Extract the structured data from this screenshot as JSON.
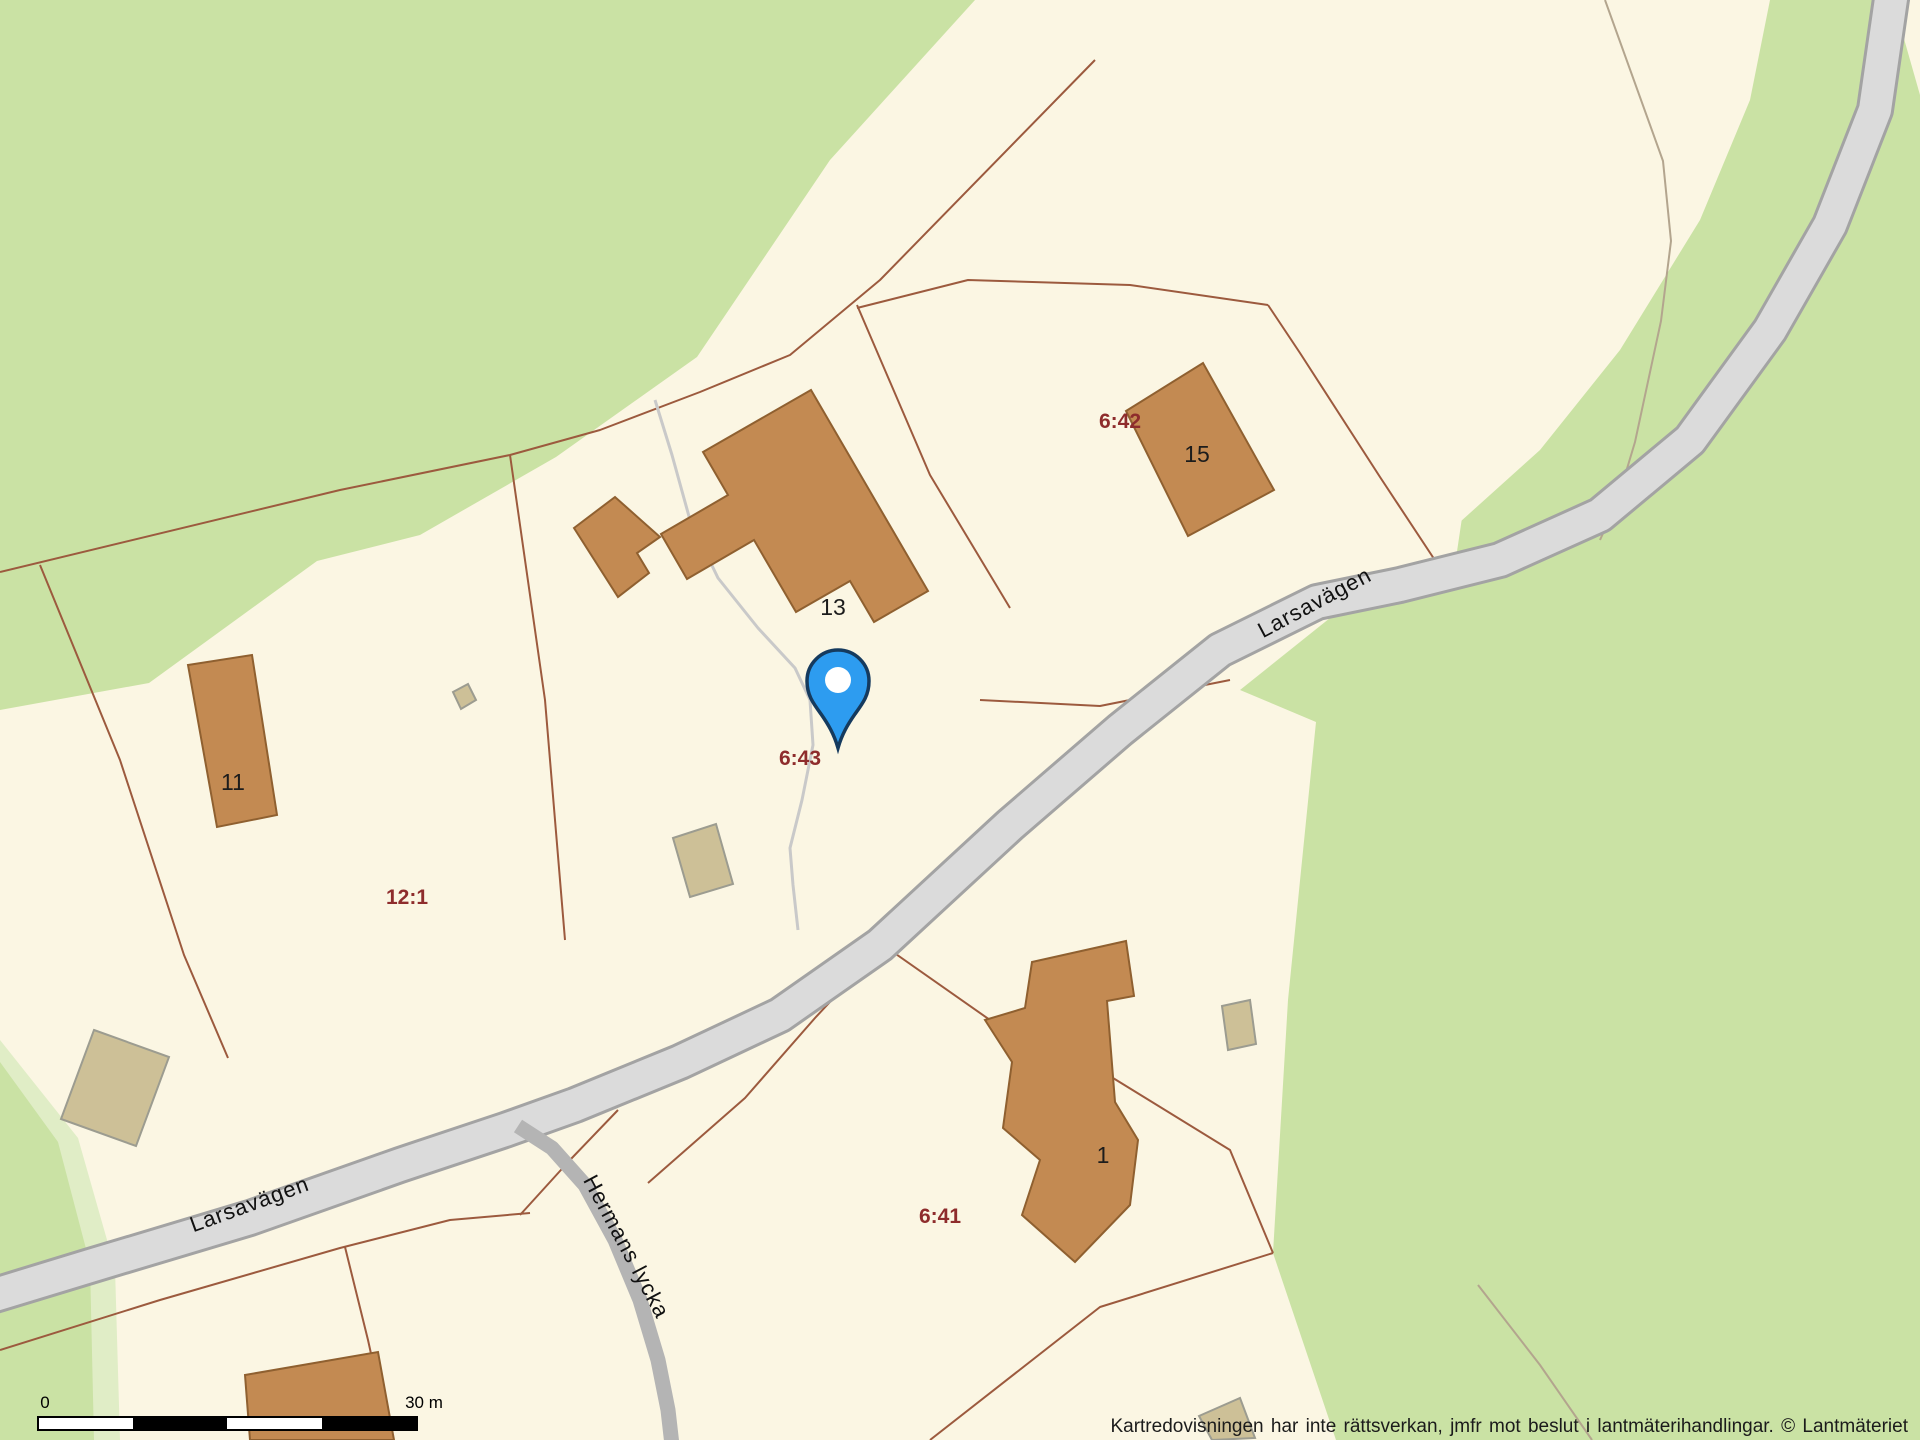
{
  "map": {
    "type": "cadastral-property-map",
    "parcel_labels": [
      {
        "text": "6:42",
        "x": 1120,
        "y": 418
      },
      {
        "text": "6:43",
        "x": 800,
        "y": 756
      },
      {
        "text": "12:1",
        "x": 407,
        "y": 895
      },
      {
        "text": "6:41",
        "x": 940,
        "y": 1214
      }
    ],
    "building_labels": [
      {
        "text": "15",
        "x": 1197,
        "y": 462
      },
      {
        "text": "13",
        "x": 833,
        "y": 615
      },
      {
        "text": "11",
        "x": 233,
        "y": 790
      },
      {
        "text": "1",
        "x": 1103,
        "y": 1163
      }
    ],
    "street_labels": [
      {
        "text": "Larsavägen",
        "x": 1318,
        "y": 601,
        "rotation": -28
      },
      {
        "text": "Larsavägen",
        "x": 252,
        "y": 1203,
        "rotation": -20
      },
      {
        "text": "Hermans lycka",
        "x": 612,
        "y": 1250,
        "rotation": 62
      }
    ],
    "marker": {
      "kind": "location-pin",
      "x": 838,
      "y": 745
    }
  },
  "scale_bar": {
    "start_label": "0",
    "end_label": "30 m"
  },
  "attribution": {
    "text": "Kartredovisningen har inte rättsverkan, jmfr mot beslut i lantmäterihandlingar. © Lantmäteriet"
  },
  "colors": {
    "cream": "#fbf6e3",
    "green": "#cae2a4",
    "green_light": "#e0edc6",
    "road": "#dbdbdb",
    "road_casing": "#a3a3a3",
    "road_minor": "#b4b4b4",
    "building": "#c38a52",
    "building_outline": "#8f6030",
    "shed": "#cdc097",
    "shed_outline": "#9c9c90",
    "parcel_line": "#9c5a3e",
    "path_line": "#c9c9c9",
    "label_red": "#8e2c2c",
    "label_black": "#1c1c1c",
    "pin": "#2d9cf0",
    "pin_outline": "#153a5e"
  }
}
